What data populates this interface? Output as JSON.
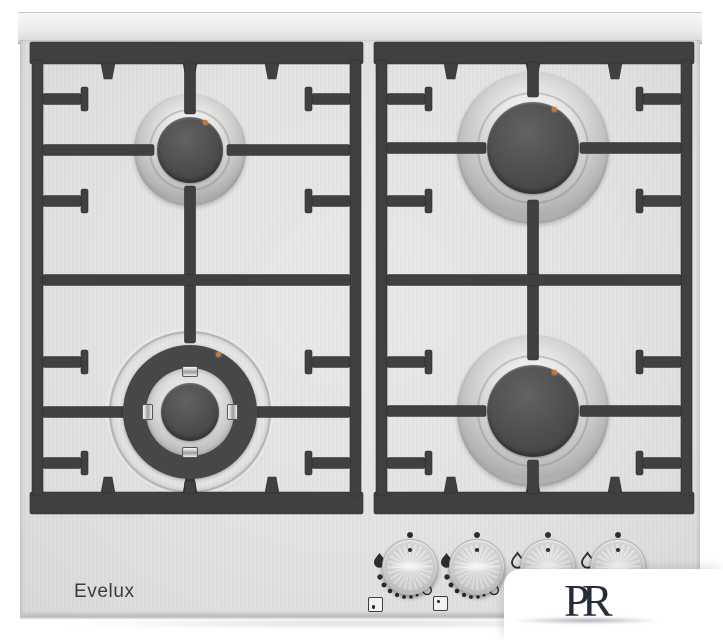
{
  "scene": {
    "description": "Stainless steel four-burner gas hob, top view product photo",
    "background": "#ffffff"
  },
  "product": {
    "brand": "Evelux"
  },
  "watermark": {
    "letter_p": "P",
    "letter_r": "R"
  },
  "burners": [
    {
      "position": "back-left",
      "size": "auxiliary"
    },
    {
      "position": "front-left",
      "size": "wok-double-ring"
    },
    {
      "position": "back-right",
      "size": "rapid"
    },
    {
      "position": "front-right",
      "size": "rapid"
    }
  ],
  "controls": {
    "knob_count": 4,
    "knob_marks": {
      "off": "dot",
      "high": "flame-filled-icon",
      "low": "flame-outline-icon"
    },
    "position_indicators": [
      {
        "knob": 1,
        "dot": "bottom-left"
      },
      {
        "knob": 2,
        "dot": "top-left"
      }
    ]
  },
  "colors": {
    "surface": "#e3e3e1",
    "grate": "#3e4042",
    "burner_cap": "#484a4c",
    "igniter": "#c07a3e",
    "knob_metal": "#d6d6d4",
    "brand_text": "#3b3b3b",
    "watermark_ink": "#272c3a",
    "watermark_card": "#ffffff"
  }
}
